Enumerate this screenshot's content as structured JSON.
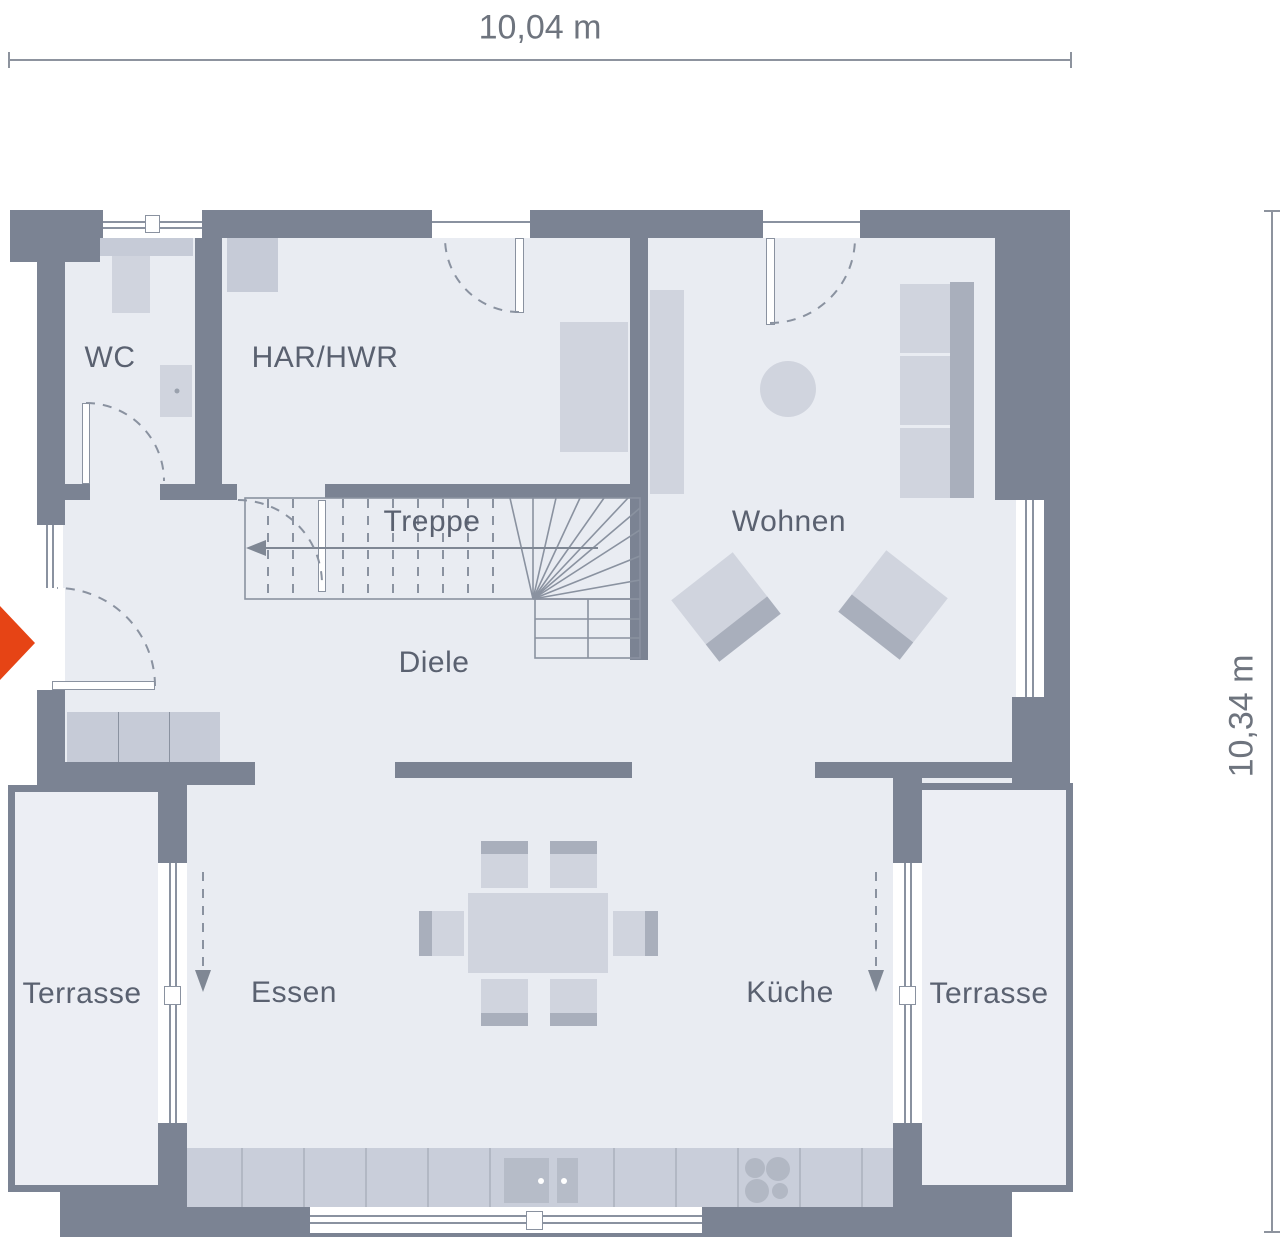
{
  "dimensions": {
    "width_label": "10,04 m",
    "height_label": "10,34 m"
  },
  "rooms": {
    "wc": "WC",
    "har": "HAR/HWR",
    "treppe": "Treppe",
    "wohnen": "Wohnen",
    "diele": "Diele",
    "essen": "Essen",
    "kueche": "Küche",
    "terrasse_left": "Terrasse",
    "terrasse_right": "Terrasse"
  },
  "icons": {
    "entrance_arrow": "right-pointing-triangle"
  },
  "colors": {
    "wall": "#7b8393",
    "floor": "#e9ecf2",
    "terrace": "#eceef4",
    "furniture": "#d0d4de",
    "furniture_mid": "#c6cbd7",
    "furniture_dark": "#a9afbc",
    "counter": "#c9ceda",
    "counter_line": "#b2b8c4",
    "appliance": "#b6bcc8",
    "line": "#8a92a0",
    "text": "#5a6170",
    "dim_text": "#6e747e",
    "accent": "#e64415",
    "window": "#ffffff"
  }
}
